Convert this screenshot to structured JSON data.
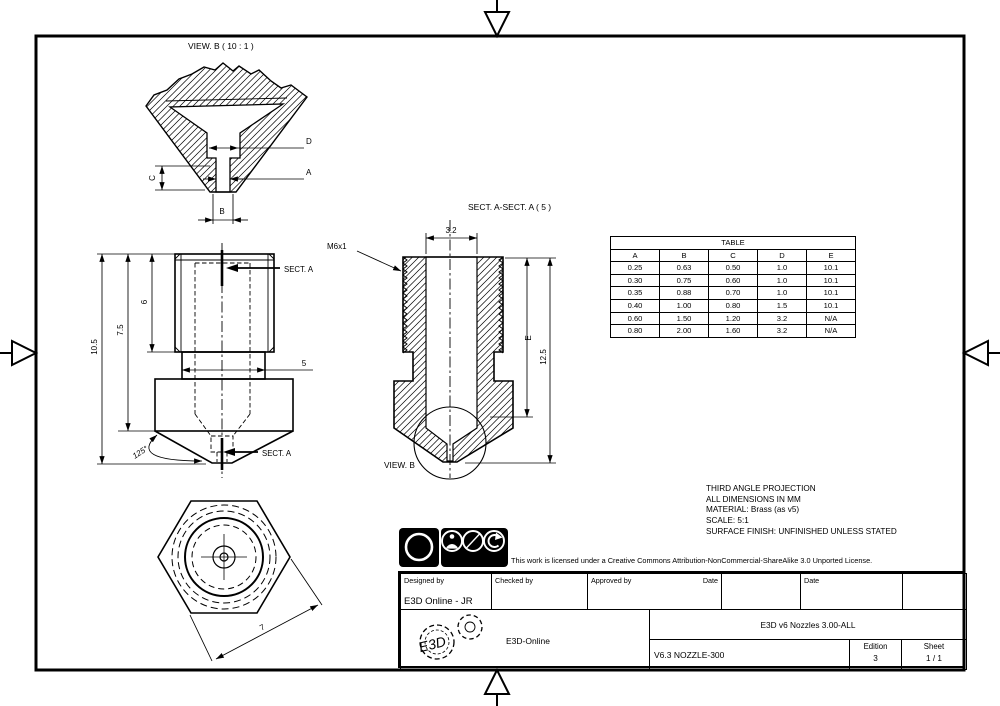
{
  "sheet": {
    "view_b_detail": {
      "title": "VIEW. B ( 10 : 1 )",
      "dim_d": "D",
      "dim_a": "A",
      "dim_c": "C",
      "dim_b": "B"
    },
    "front_view": {
      "dim_overall": "10.5",
      "dim_to_hex": "7.5",
      "dim_thread": "6",
      "dim_neck": "5",
      "dim_angle": "125°",
      "section_label": "SECT. A"
    },
    "section_view": {
      "title": "SECT. A-SECT. A ( 5 )",
      "thread_callout": "M6x1",
      "dim_bore": "3.2",
      "dim_e": "E",
      "dim_height": "12.5",
      "detail_ref": "VIEW. B"
    },
    "end_view": {
      "dim_hex": "7"
    }
  },
  "table": {
    "title": "TABLE",
    "headers": [
      "A",
      "B",
      "C",
      "D",
      "E"
    ],
    "rows": [
      [
        "0.25",
        "0.63",
        "0.50",
        "1.0",
        "10.1"
      ],
      [
        "0.30",
        "0.75",
        "0.60",
        "1.0",
        "10.1"
      ],
      [
        "0.35",
        "0.88",
        "0.70",
        "1.0",
        "10.1"
      ],
      [
        "0.40",
        "1.00",
        "0.80",
        "1.5",
        "10.1"
      ],
      [
        "0.60",
        "1.50",
        "1.20",
        "3.2",
        "N/A"
      ],
      [
        "0.80",
        "2.00",
        "1.60",
        "3.2",
        "N/A"
      ]
    ]
  },
  "notes": {
    "lines": [
      "THIRD ANGLE PROJECTION",
      "ALL DIMENSIONS IN MM",
      "MATERIAL: Brass (as v5)",
      "SCALE: 5:1",
      "SURFACE FINISH: UNFINISHED UNLESS STATED"
    ]
  },
  "license": {
    "cc": "cc",
    "by": "BY",
    "nc": "NC",
    "sa": "SA",
    "nc_symbol": "$",
    "text": "This work is licensed under a Creative Commons Attribution-NonCommercial-ShareAlike 3.0 Unported License."
  },
  "title_block": {
    "designed_by_label": "Designed by",
    "designed_by_value": "E3D Online - JR",
    "checked_by_label": "Checked by",
    "approved_by_label": "Approved by",
    "date_label_1": "Date",
    "date_label_2": "Date",
    "logo_text": "E3D",
    "company": "E3D-Online",
    "drawing_title": "E3D v6 Nozzles 3.00-ALL",
    "part_number": "V6.3 NOZZLE-300",
    "edition_label": "Edition",
    "edition_value": "3",
    "sheet_label": "Sheet",
    "sheet_value": "1 / 1"
  }
}
